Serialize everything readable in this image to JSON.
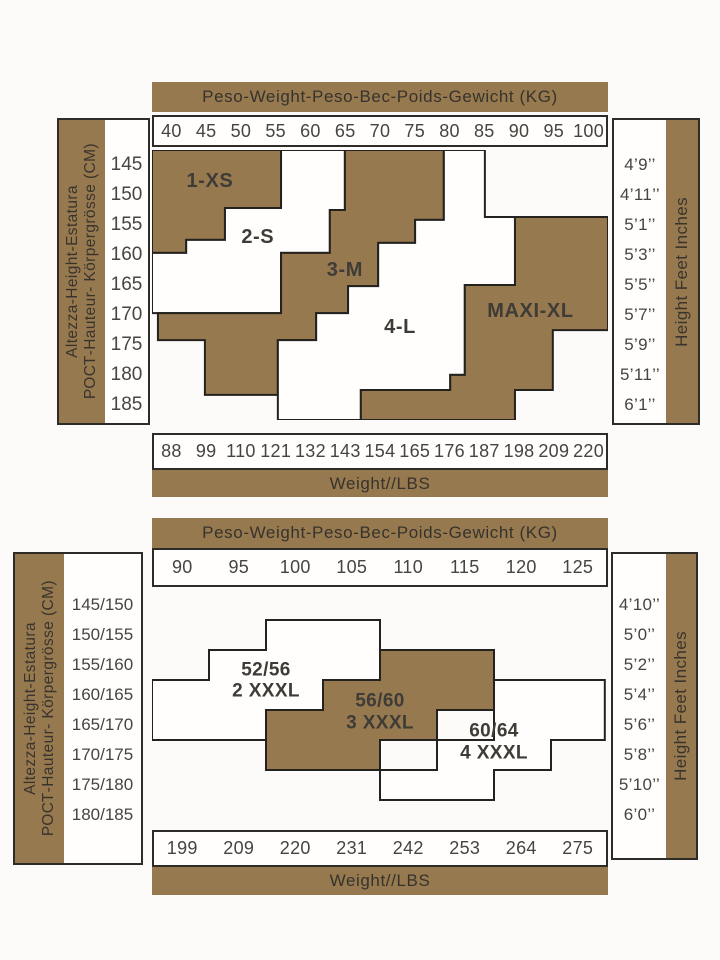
{
  "colors": {
    "brown": "#97794f",
    "outline": "#24221e",
    "region_white": "#fffefc"
  },
  "chart_data": [
    {
      "type": "stepped-region-map",
      "title": "Peso-Weight-Peso-Bec-Poids-Gewicht (KG)",
      "weight_kg": [
        "40",
        "45",
        "50",
        "55",
        "60",
        "65",
        "70",
        "75",
        "80",
        "85",
        "90",
        "95",
        "100"
      ],
      "weight_lbs": [
        "88",
        "99",
        "110",
        "121",
        "132",
        "143",
        "154",
        "165",
        "176",
        "187",
        "198",
        "209",
        "220"
      ],
      "weight_lbs_label": "Weight//LBS",
      "height_cm": [
        "145",
        "150",
        "155",
        "160",
        "165",
        "170",
        "175",
        "180",
        "185"
      ],
      "height_ft": [
        "4’9’’",
        "4’11’’",
        "5’1’’",
        "5’3’’",
        "5’5’’",
        "5’7’’",
        "5’9’’",
        "5’11’’",
        "6’1’’"
      ],
      "left_axis_label_line1": "Altezza-Height-Estatura",
      "left_axis_label_line2": "РОСТ-Hauteur- Körpergrösse (CM)",
      "right_axis_label": "Height Feet Inches",
      "regions": [
        {
          "label_lines": [
            "1-XS"
          ],
          "size": "1-XS",
          "fill": "brown",
          "label_pos": [
            12.7,
            11.5
          ],
          "points": [
            [
              0,
              0
            ],
            [
              28.3,
              0
            ],
            [
              28.3,
              21.5
            ],
            [
              16,
              21.5
            ],
            [
              16,
              33.3
            ],
            [
              7.5,
              33.3
            ],
            [
              7.5,
              38.1
            ],
            [
              0,
              38.1
            ]
          ]
        },
        {
          "label_lines": [
            "2-S"
          ],
          "size": "2-S",
          "fill": "white",
          "label_pos": [
            23.2,
            32.2
          ],
          "points": [
            [
              28.3,
              0
            ],
            [
              42.3,
              0
            ],
            [
              42.3,
              22.2
            ],
            [
              39,
              22.2
            ],
            [
              39,
              38.1
            ],
            [
              28.3,
              38.1
            ],
            [
              28.3,
              60.4
            ],
            [
              0,
              60.4
            ],
            [
              0,
              38.1
            ],
            [
              7.5,
              38.1
            ],
            [
              7.5,
              33.3
            ],
            [
              16,
              33.3
            ],
            [
              16,
              21.5
            ],
            [
              28.3,
              21.5
            ]
          ]
        },
        {
          "label_lines": [
            "3-M"
          ],
          "size": "3-M",
          "fill": "brown",
          "label_pos": [
            42.3,
            44.4
          ],
          "points": [
            [
              42.3,
              0
            ],
            [
              64,
              0
            ],
            [
              64,
              25.9
            ],
            [
              57.7,
              25.9
            ],
            [
              57.7,
              34.4
            ],
            [
              49.6,
              34.4
            ],
            [
              49.6,
              50.4
            ],
            [
              43,
              50.4
            ],
            [
              43,
              60.4
            ],
            [
              36,
              60.4
            ],
            [
              36,
              70.4
            ],
            [
              27.6,
              70.4
            ],
            [
              27.6,
              90.7
            ],
            [
              11.6,
              90.7
            ],
            [
              11.6,
              70.4
            ],
            [
              1.3,
              70.4
            ],
            [
              1.3,
              60.4
            ],
            [
              28.3,
              60.4
            ],
            [
              28.3,
              38.1
            ],
            [
              39,
              38.1
            ],
            [
              39,
              22.2
            ],
            [
              42.3,
              22.2
            ]
          ]
        },
        {
          "label_lines": [
            "4-L"
          ],
          "size": "4-L",
          "fill": "white",
          "label_pos": [
            54.4,
            65.5
          ],
          "points": [
            [
              64,
              0
            ],
            [
              73,
              0
            ],
            [
              73,
              24.8
            ],
            [
              79.6,
              24.8
            ],
            [
              79.6,
              50
            ],
            [
              68.6,
              50
            ],
            [
              68.6,
              83.3
            ],
            [
              65.4,
              83.3
            ],
            [
              65.4,
              88.9
            ],
            [
              45.8,
              88.9
            ],
            [
              45.8,
              100
            ],
            [
              27.6,
              100
            ],
            [
              27.6,
              70.4
            ],
            [
              36,
              70.4
            ],
            [
              36,
              60.4
            ],
            [
              43,
              60.4
            ],
            [
              43,
              50.4
            ],
            [
              49.6,
              50.4
            ],
            [
              49.6,
              34.4
            ],
            [
              57.7,
              34.4
            ],
            [
              57.7,
              25.9
            ],
            [
              64,
              25.9
            ]
          ]
        },
        {
          "label_lines": [
            "MAXI-XL"
          ],
          "size": "MAXI-XL",
          "fill": "brown",
          "label_pos": [
            83,
            59.5
          ],
          "points": [
            [
              79.6,
              24.8
            ],
            [
              100,
              24.8
            ],
            [
              100,
              66.7
            ],
            [
              87.9,
              66.7
            ],
            [
              87.9,
              88.9
            ],
            [
              79.6,
              88.9
            ],
            [
              79.6,
              100
            ],
            [
              45.8,
              100
            ],
            [
              45.8,
              88.9
            ],
            [
              65.4,
              88.9
            ],
            [
              65.4,
              83.3
            ],
            [
              68.6,
              83.3
            ],
            [
              68.6,
              50
            ],
            [
              79.6,
              50
            ]
          ]
        }
      ]
    },
    {
      "type": "stepped-region-map",
      "title": "Peso-Weight-Peso-Bec-Poids-Gewicht (KG)",
      "weight_kg": [
        "90",
        "95",
        "100",
        "105",
        "110",
        "115",
        "120",
        "125"
      ],
      "weight_lbs": [
        "199",
        "209",
        "220",
        "231",
        "242",
        "253",
        "264",
        "275"
      ],
      "weight_lbs_label": "Weight//LBS",
      "height_cm": [
        "145/150",
        "150/155",
        "155/160",
        "160/165",
        "165/170",
        "170/175",
        "175/180",
        "180/185"
      ],
      "height_ft": [
        "4’10’’",
        "5’0’’",
        "5’2’’",
        "5’4’’",
        "5’6’’",
        "5’8’’",
        "5’10’’",
        "6’0’’"
      ],
      "left_axis_label_line1": "Altezza-Height-Estatura",
      "left_axis_label_line2": "РОСТ-Hauteur- Körpergrösse (CM)",
      "right_axis_label": "Height Feet Inches",
      "regions": [
        {
          "label_lines": [
            "52/56",
            "2 XXXL"
          ],
          "size": "52/56 2 XXXL",
          "fill": "white",
          "label_pos": [
            25,
            38
          ],
          "points": [
            [
              25,
              12.5
            ],
            [
              50,
              12.5
            ],
            [
              50,
              37.5
            ],
            [
              37.5,
              37.5
            ],
            [
              37.5,
              50
            ],
            [
              25,
              50
            ],
            [
              25,
              62.5
            ],
            [
              0,
              62.5
            ],
            [
              0,
              37.5
            ],
            [
              12.5,
              37.5
            ],
            [
              12.5,
              25
            ],
            [
              25,
              25
            ]
          ]
        },
        {
          "label_lines": [
            "56/60",
            "3 XXXL"
          ],
          "size": "56/60 3 XXXL",
          "fill": "brown",
          "label_pos": [
            50,
            51
          ],
          "points": [
            [
              50,
              25
            ],
            [
              75,
              25
            ],
            [
              75,
              50
            ],
            [
              62.5,
              50
            ],
            [
              62.5,
              62.5
            ],
            [
              50,
              62.5
            ],
            [
              50,
              75
            ],
            [
              25,
              75
            ],
            [
              25,
              50
            ],
            [
              37.5,
              50
            ],
            [
              37.5,
              37.5
            ],
            [
              50,
              37.5
            ]
          ]
        },
        {
          "label_lines": [
            "60/64",
            "4 XXXL"
          ],
          "size": "60/64 4 XXXL",
          "fill": "white",
          "label_pos": [
            75,
            63.5
          ],
          "points": [
            [
              75,
              37.5
            ],
            [
              99.3,
              37.5
            ],
            [
              99.3,
              62.5
            ],
            [
              87.5,
              62.5
            ],
            [
              87.5,
              75
            ],
            [
              75,
              75
            ],
            [
              75,
              87.5
            ],
            [
              50,
              87.5
            ],
            [
              50,
              75
            ],
            [
              62.5,
              75
            ],
            [
              62.5,
              62.5
            ],
            [
              75,
              62.5
            ]
          ]
        }
      ]
    }
  ]
}
